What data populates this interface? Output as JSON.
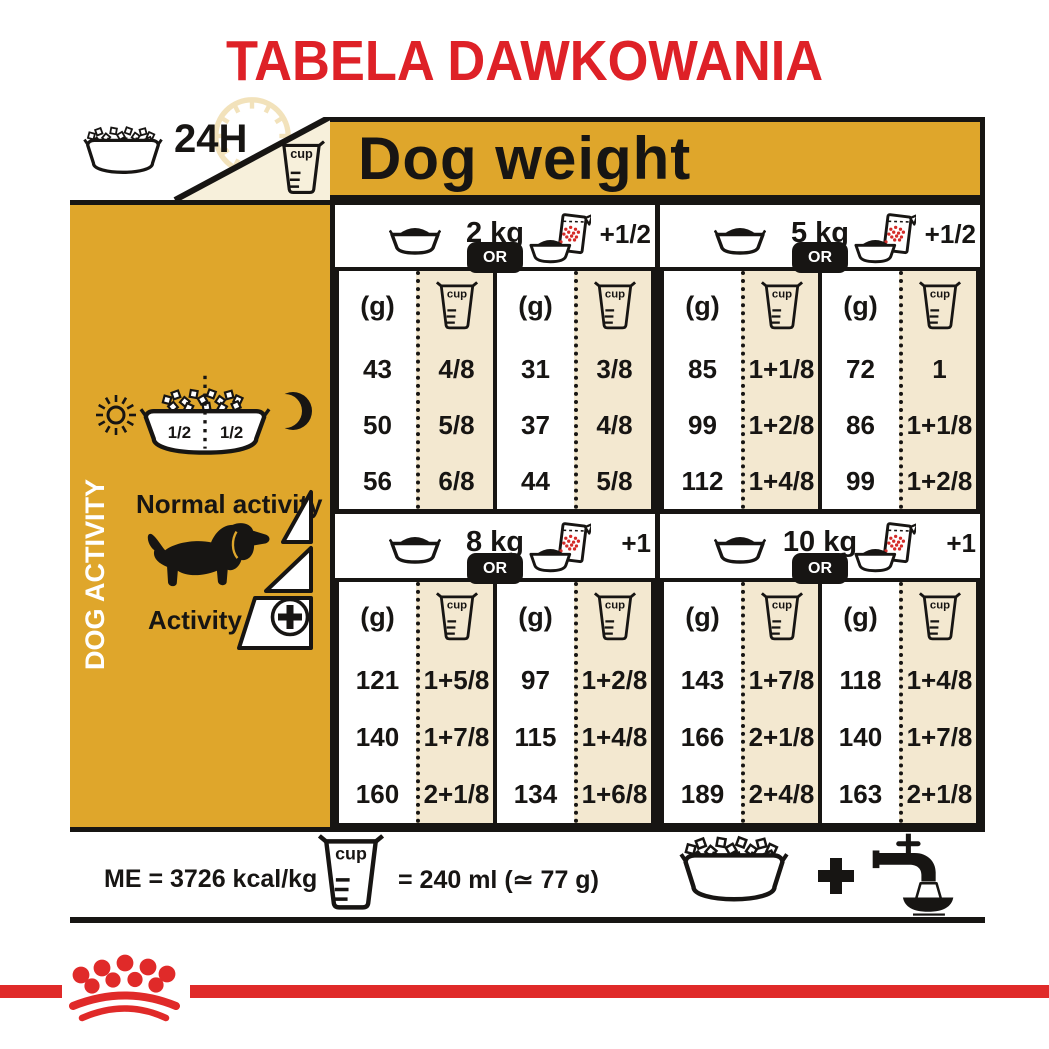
{
  "title": "TABELA DAWKOWANIA",
  "labels": {
    "cup": "cup",
    "duration": "24H"
  },
  "header": {
    "dog_weight": "Dog weight"
  },
  "sidebar": {
    "vertical_label": "DOG ACTIVITY",
    "half_left": "1/2",
    "half_right": "1/2",
    "normal_activity": "Normal activity",
    "activity": "Activity"
  },
  "table": {
    "or_label": "OR",
    "grams_header": "(g)",
    "quadrants": [
      {
        "weight": "2 kg",
        "extra": "+1/2",
        "tables": [
          {
            "rows": [
              {
                "g": "43",
                "cup": "4/8"
              },
              {
                "g": "50",
                "cup": "5/8"
              },
              {
                "g": "56",
                "cup": "6/8"
              }
            ]
          },
          {
            "rows": [
              {
                "g": "31",
                "cup": "3/8"
              },
              {
                "g": "37",
                "cup": "4/8"
              },
              {
                "g": "44",
                "cup": "5/8"
              }
            ]
          }
        ]
      },
      {
        "weight": "5 kg",
        "extra": "+1/2",
        "tables": [
          {
            "rows": [
              {
                "g": "85",
                "cup": "1+1/8"
              },
              {
                "g": "99",
                "cup": "1+2/8"
              },
              {
                "g": "112",
                "cup": "1+4/8"
              }
            ]
          },
          {
            "rows": [
              {
                "g": "72",
                "cup": "1"
              },
              {
                "g": "86",
                "cup": "1+1/8"
              },
              {
                "g": "99",
                "cup": "1+2/8"
              }
            ]
          }
        ]
      },
      {
        "weight": "8 kg",
        "extra": "+1",
        "tables": [
          {
            "rows": [
              {
                "g": "121",
                "cup": "1+5/8"
              },
              {
                "g": "140",
                "cup": "1+7/8"
              },
              {
                "g": "160",
                "cup": "2+1/8"
              }
            ]
          },
          {
            "rows": [
              {
                "g": "97",
                "cup": "1+2/8"
              },
              {
                "g": "115",
                "cup": "1+4/8"
              },
              {
                "g": "134",
                "cup": "1+6/8"
              }
            ]
          }
        ]
      },
      {
        "weight": "10 kg",
        "extra": "+1",
        "tables": [
          {
            "rows": [
              {
                "g": "143",
                "cup": "1+7/8"
              },
              {
                "g": "166",
                "cup": "2+1/8"
              },
              {
                "g": "189",
                "cup": "2+4/8"
              }
            ]
          },
          {
            "rows": [
              {
                "g": "118",
                "cup": "1+4/8"
              },
              {
                "g": "140",
                "cup": "1+7/8"
              },
              {
                "g": "163",
                "cup": "2+1/8"
              }
            ]
          }
        ]
      }
    ]
  },
  "footer": {
    "me": "ME = 3726 kcal/kg",
    "equals": "= 240 ml (≃ 77 g)",
    "plus": "+"
  },
  "colors": {
    "brand_red": "#DE2127",
    "gold": "#DFA62B",
    "beige": "#F3E8D0",
    "triangle_beige": "#F7F0DB",
    "ink": "#171513"
  }
}
